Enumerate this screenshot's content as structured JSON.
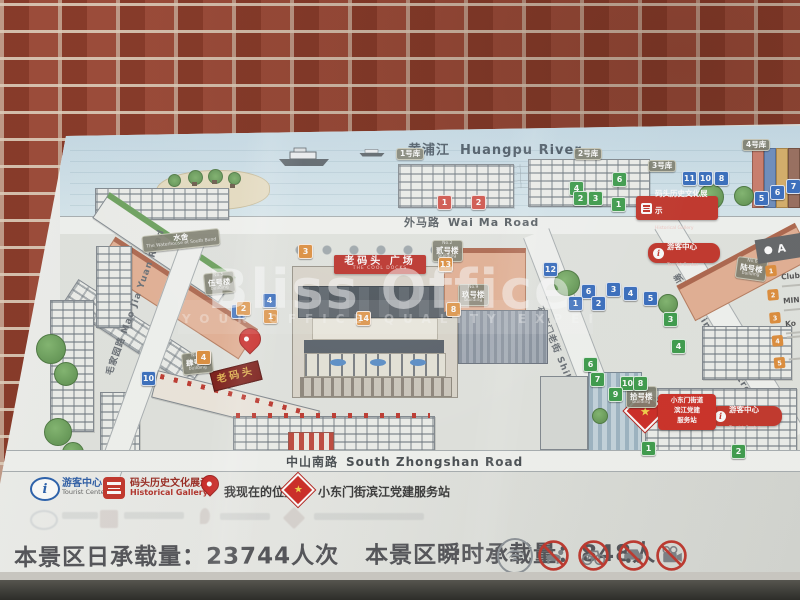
{
  "watermark": {
    "title": "Bliss Office",
    "subtitle": "YOUR OFFICE QUALITY EXPERT"
  },
  "map": {
    "river": {
      "zh": "黄浦江",
      "en": "Huangpu River"
    },
    "roads": {
      "waima": {
        "zh": "外马路",
        "en": "Wai Ma Road"
      },
      "zhongshan": {
        "zh": "中山南路",
        "en": "South Zhongshan Road"
      },
      "maojiayuan": {
        "zh": "毛家园路",
        "en": "Mao Jia Yuan Road"
      },
      "shikumen": {
        "zh": "石库门老街",
        "en": "Shikumen Old Street"
      },
      "xinmatou": {
        "zh": "新码头街",
        "en": "Xin Ma Tou Street"
      }
    },
    "plaza": {
      "zh": "老码头 广场",
      "en": "THE COOL DOCKS"
    },
    "laomatou_sign": "老码头",
    "poi": {
      "tourist": {
        "zh": "游客中心",
        "en": "Tourist Center"
      },
      "gallery": {
        "zh": "码头历史文化展示",
        "en": "Historical Gallery"
      },
      "party_lines": [
        "小东门街道",
        "滨江党建",
        "服务站"
      ]
    },
    "tags": [
      {
        "m": "1号库",
        "x": 396,
        "y": 148,
        "r": 0
      },
      {
        "m": "2号库",
        "x": 574,
        "y": 148,
        "r": 0
      },
      {
        "m": "3号库",
        "x": 648,
        "y": 160,
        "r": 0
      },
      {
        "m": "4号库",
        "x": 742,
        "y": 139,
        "r": 0
      },
      {
        "m": "水舍",
        "b": "The Waterhouse at South Bund",
        "x": 142,
        "y": 232,
        "r": -6
      },
      {
        "t": "No.5",
        "m": "伍号楼",
        "b": "building",
        "x": 204,
        "y": 272,
        "r": -6
      },
      {
        "t": "No.4",
        "m": "肆号楼",
        "b": "building",
        "x": 182,
        "y": 352,
        "r": -6
      },
      {
        "t": "No.2",
        "m": "贰号楼",
        "b": "building",
        "x": 432,
        "y": 240,
        "r": 0
      },
      {
        "t": "No.9",
        "m": "玖号楼",
        "b": "building",
        "x": 458,
        "y": 284,
        "r": 0
      },
      {
        "t": "No.10",
        "m": "拾号楼",
        "b": "building",
        "x": 626,
        "y": 386,
        "r": 0
      },
      {
        "t": "No.6",
        "m": "陆号楼",
        "b": "building",
        "x": 736,
        "y": 258,
        "r": 8
      }
    ],
    "markers": [
      {
        "n": "1",
        "c": "red",
        "x": 437,
        "y": 195
      },
      {
        "n": "2",
        "c": "red",
        "x": 471,
        "y": 195
      },
      {
        "n": "4",
        "c": "green",
        "x": 569,
        "y": 181
      },
      {
        "n": "6",
        "c": "green",
        "x": 612,
        "y": 172
      },
      {
        "n": "2",
        "c": "green",
        "x": 573,
        "y": 191
      },
      {
        "n": "3",
        "c": "green",
        "x": 588,
        "y": 191
      },
      {
        "n": "1",
        "c": "green",
        "x": 611,
        "y": 197
      },
      {
        "n": "11",
        "c": "blue",
        "x": 682,
        "y": 171
      },
      {
        "n": "10",
        "c": "blue",
        "x": 698,
        "y": 171
      },
      {
        "n": "8",
        "c": "blue",
        "x": 714,
        "y": 171
      },
      {
        "n": "5",
        "c": "blue",
        "x": 754,
        "y": 191
      },
      {
        "n": "6",
        "c": "blue",
        "x": 770,
        "y": 185
      },
      {
        "n": "7",
        "c": "blue",
        "x": 786,
        "y": 179
      },
      {
        "n": "12",
        "c": "blue",
        "x": 543,
        "y": 262
      },
      {
        "n": "6",
        "c": "blue",
        "x": 581,
        "y": 284
      },
      {
        "n": "3",
        "c": "blue",
        "x": 606,
        "y": 282
      },
      {
        "n": "4",
        "c": "blue",
        "x": 623,
        "y": 286
      },
      {
        "n": "5",
        "c": "blue",
        "x": 643,
        "y": 291
      },
      {
        "n": "1",
        "c": "blue",
        "x": 568,
        "y": 296
      },
      {
        "n": "2",
        "c": "blue",
        "x": 591,
        "y": 296
      },
      {
        "n": "4",
        "c": "blue",
        "x": 262,
        "y": 293
      },
      {
        "n": "2",
        "c": "blue",
        "x": 231,
        "y": 304
      },
      {
        "n": "10",
        "c": "blue",
        "x": 141,
        "y": 371
      },
      {
        "n": "2",
        "c": "orange",
        "x": 236,
        "y": 301
      },
      {
        "n": "1",
        "c": "orange",
        "x": 263,
        "y": 309
      },
      {
        "n": "3",
        "c": "orange",
        "x": 298,
        "y": 244
      },
      {
        "n": "13",
        "c": "orange",
        "x": 438,
        "y": 257
      },
      {
        "n": "8",
        "c": "orange",
        "x": 446,
        "y": 302
      },
      {
        "n": "14",
        "c": "orange",
        "x": 356,
        "y": 311
      },
      {
        "n": "4",
        "c": "orange",
        "x": 196,
        "y": 350
      },
      {
        "n": "3",
        "c": "green",
        "x": 663,
        "y": 312
      },
      {
        "n": "4",
        "c": "green",
        "x": 671,
        "y": 339
      },
      {
        "n": "6",
        "c": "green",
        "x": 583,
        "y": 357
      },
      {
        "n": "7",
        "c": "green",
        "x": 590,
        "y": 372
      },
      {
        "n": "10",
        "c": "green",
        "x": 620,
        "y": 376
      },
      {
        "n": "8",
        "c": "green",
        "x": 633,
        "y": 376
      },
      {
        "n": "9",
        "c": "green",
        "x": 608,
        "y": 387
      },
      {
        "n": "1",
        "c": "green",
        "x": 641,
        "y": 441
      },
      {
        "n": "2",
        "c": "green",
        "x": 731,
        "y": 444
      }
    ]
  },
  "side_panel": {
    "header": "A",
    "items": [
      {
        "n": "1",
        "label": "Club"
      },
      {
        "n": "2",
        "label": "MIN"
      },
      {
        "n": "3",
        "label": "Ko"
      },
      {
        "n": "4",
        "label": ""
      },
      {
        "n": "5",
        "label": ""
      }
    ]
  },
  "legend": {
    "tourist": {
      "zh": "游客中心",
      "en": "Tourist Center"
    },
    "gallery": {
      "zh": "码头历史文化展示",
      "en": "Historical Gallery"
    },
    "location": {
      "zh": "我现在的位置"
    },
    "party": {
      "zh": "小东门街滨江党建服务站"
    }
  },
  "capacity": {
    "daily": "本景区日承载量：23744人次",
    "instant": "本景区瞬时承载量：848人"
  },
  "bottom_icons": [
    "wifi",
    "no-pets",
    "no-bicycles",
    "no-vehicles",
    "no-filming"
  ]
}
